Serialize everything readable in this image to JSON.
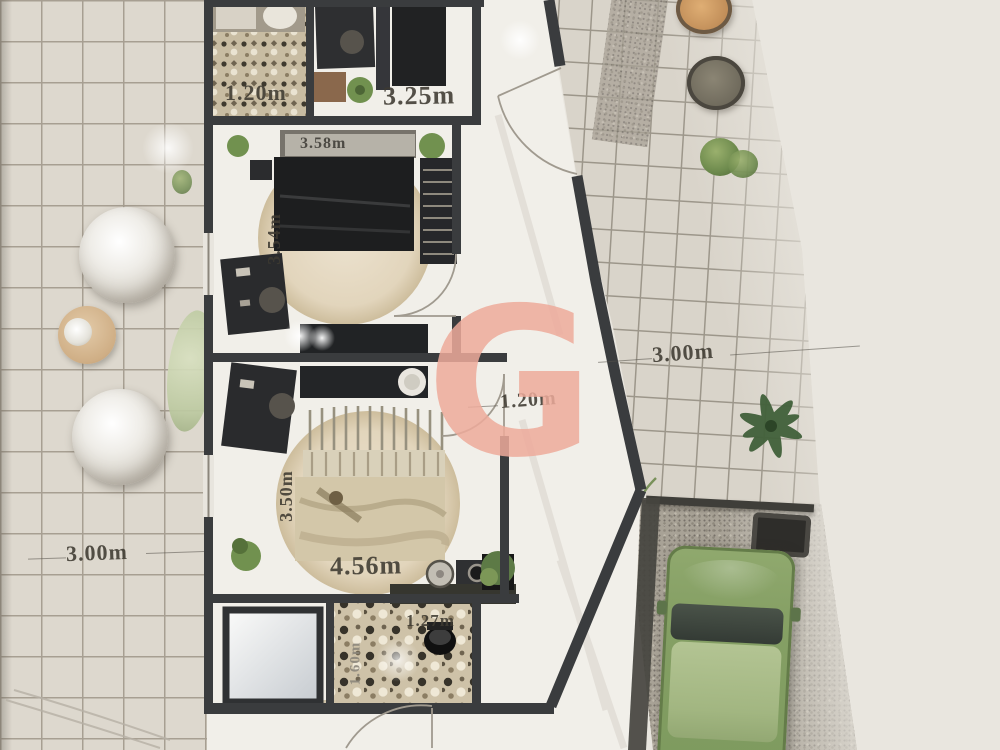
{
  "plan": {
    "watermark_letter": "G",
    "labels": {
      "top_closet_width": "1.20m",
      "study_width": "3.25m",
      "bedroom1_width": "3.58m",
      "bedroom1_depth": "3.54m",
      "yard_right_depth": "3.00m",
      "hall_width": "1.20m",
      "yard_left_depth": "3.00m",
      "bedroom2_depth": "3.50m",
      "bedroom2_width": "4.56m",
      "bathroom_width": "1.27m",
      "bathroom_depth": "1.60m"
    },
    "palette": {
      "background": "#e9e6df",
      "tile": "#ddd8ce",
      "grout": "#a79f92",
      "wall": "#3a3c3e",
      "floor": "#f1efe9",
      "rug": "#e4d8c0",
      "watermark": "#eeab9b",
      "car_green": "#86a065",
      "gravel": "#a8a296"
    }
  }
}
